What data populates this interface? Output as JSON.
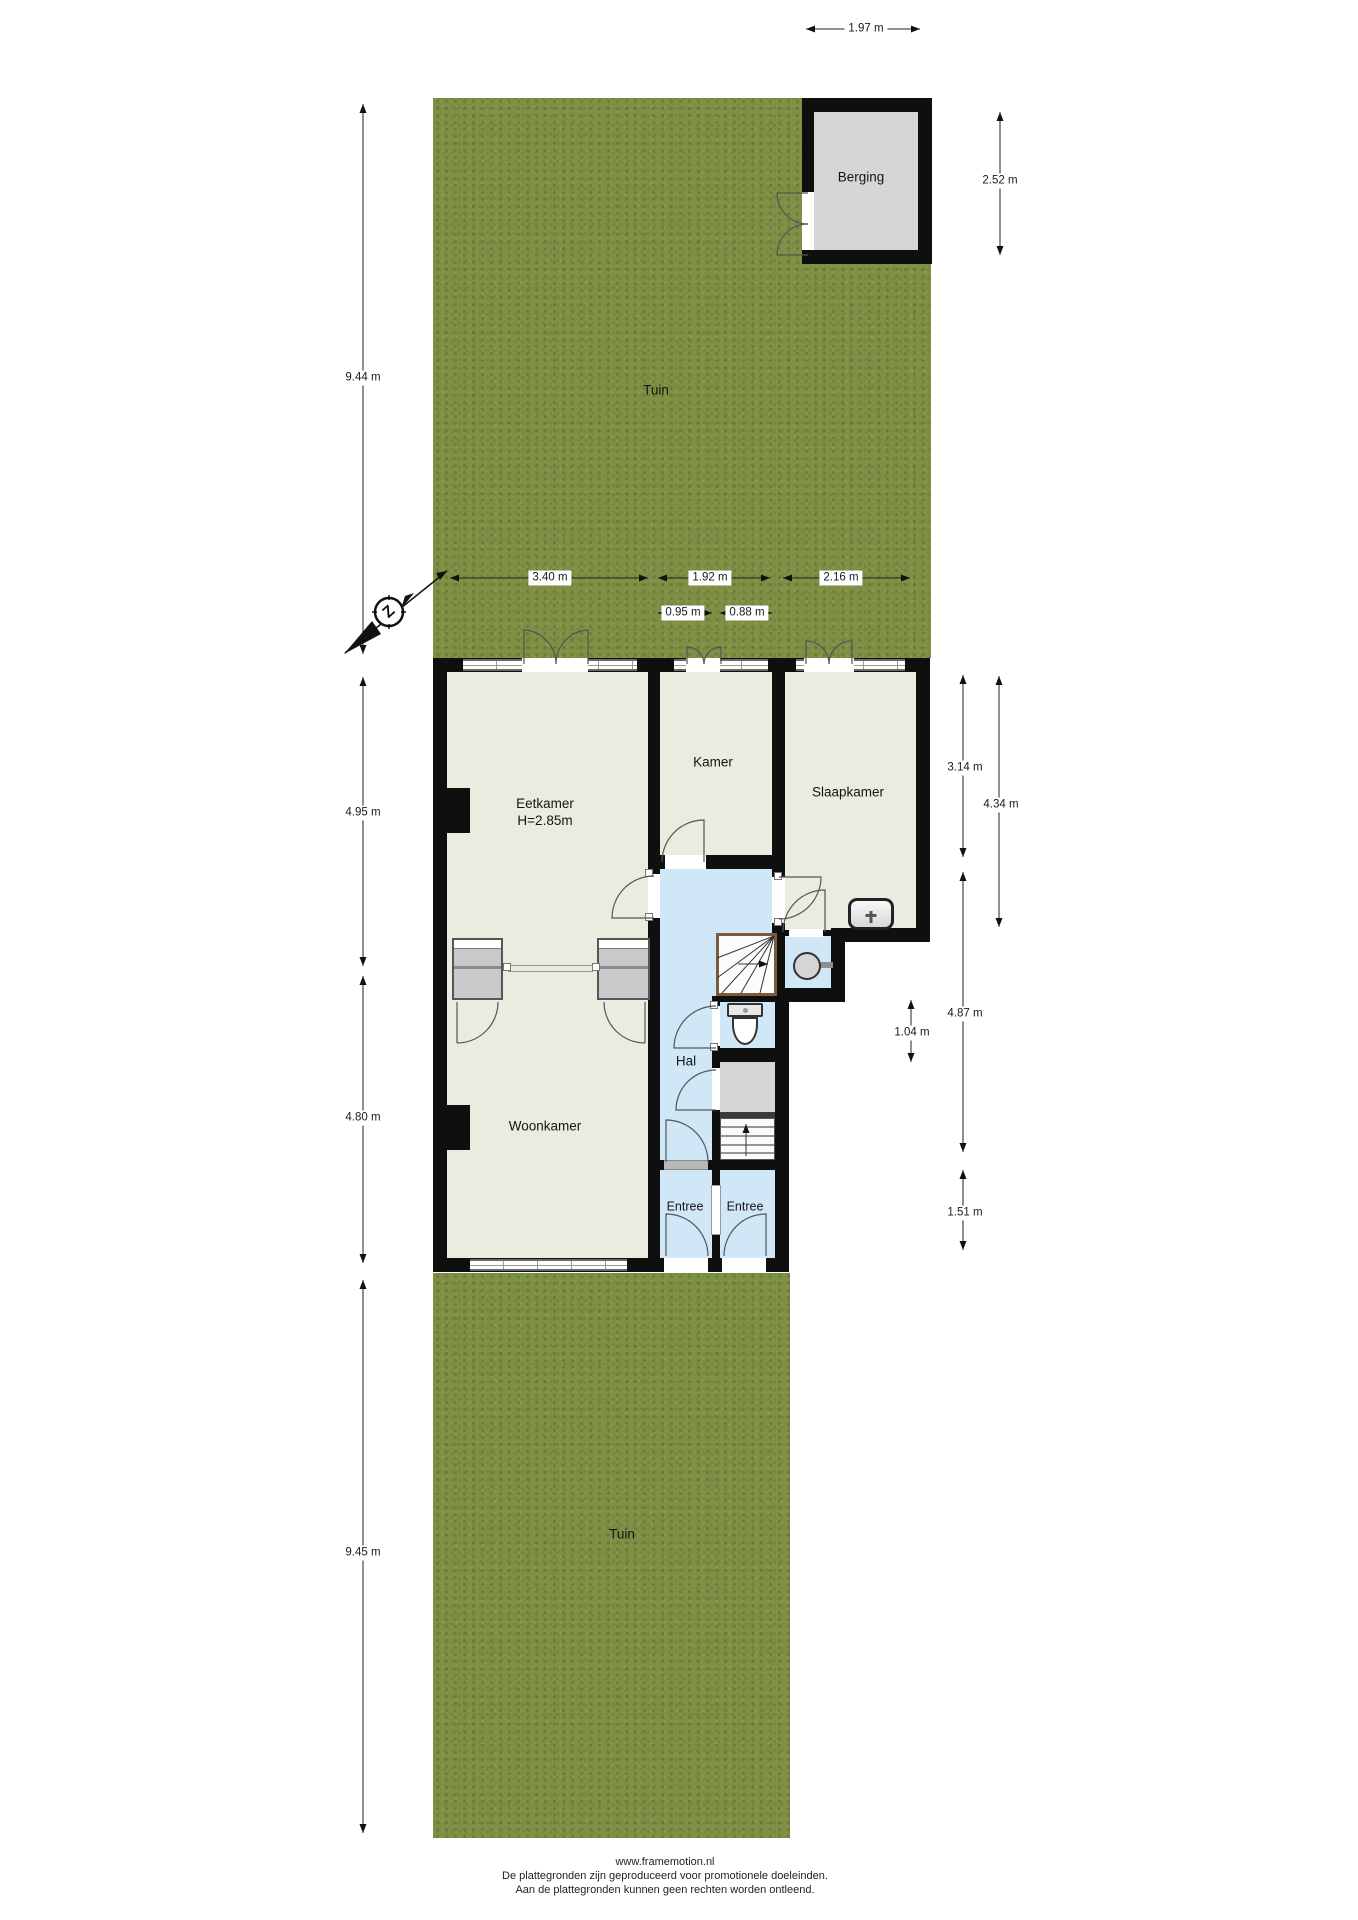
{
  "colors": {
    "grass": "#7d9045",
    "floor": "#ecebdf",
    "hall": "#cfe7f7",
    "wall": "#0f0f0f",
    "storage": "#d6d6d6",
    "closet": "#c9c9cb",
    "stair_frame": "#7b5b3c",
    "dim_text": "#1a1a1a"
  },
  "compass": {
    "label": "Z"
  },
  "rooms": {
    "tuin_top": {
      "label": "Tuin"
    },
    "berging": {
      "label": "Berging"
    },
    "eetkamer": {
      "label": "Eetkamer",
      "height": "H=2.85m"
    },
    "kamer": {
      "label": "Kamer"
    },
    "slaapkamer": {
      "label": "Slaapkamer"
    },
    "hal": {
      "label": "Hal"
    },
    "woonkamer": {
      "label": "Woonkamer"
    },
    "entree_links": {
      "label": "Entree"
    },
    "entree_rechts": {
      "label": "Entree"
    },
    "tuin_onder": {
      "label": "Tuin"
    }
  },
  "dimensions": {
    "berging_breedte": "1.97 m",
    "berging_diepte": "2.52 m",
    "tuin_boven_diepte": "9.44 m",
    "eetkamer_breedte": "3.40 m",
    "kamer_breedte": "1.92 m",
    "slaapkamer_breedte": "2.16 m",
    "maat_095": "0.95 m",
    "maat_088": "0.88 m",
    "links_boven": "4.95 m",
    "links_onder": "4.80 m",
    "tuin_onder_diepte": "9.45 m",
    "rechts_1": "3.14 m",
    "rechts_2": "4.34 m",
    "rechts_3": "4.87 m",
    "maat_104": "1.04 m",
    "rechts_4": "1.51 m"
  },
  "footer": {
    "line1": "www.framemotion.nl",
    "line2": "De plattegronden zijn geproduceerd voor promotionele doeleinden.",
    "line3": "Aan de plattegronden kunnen geen rechten worden ontleend."
  }
}
